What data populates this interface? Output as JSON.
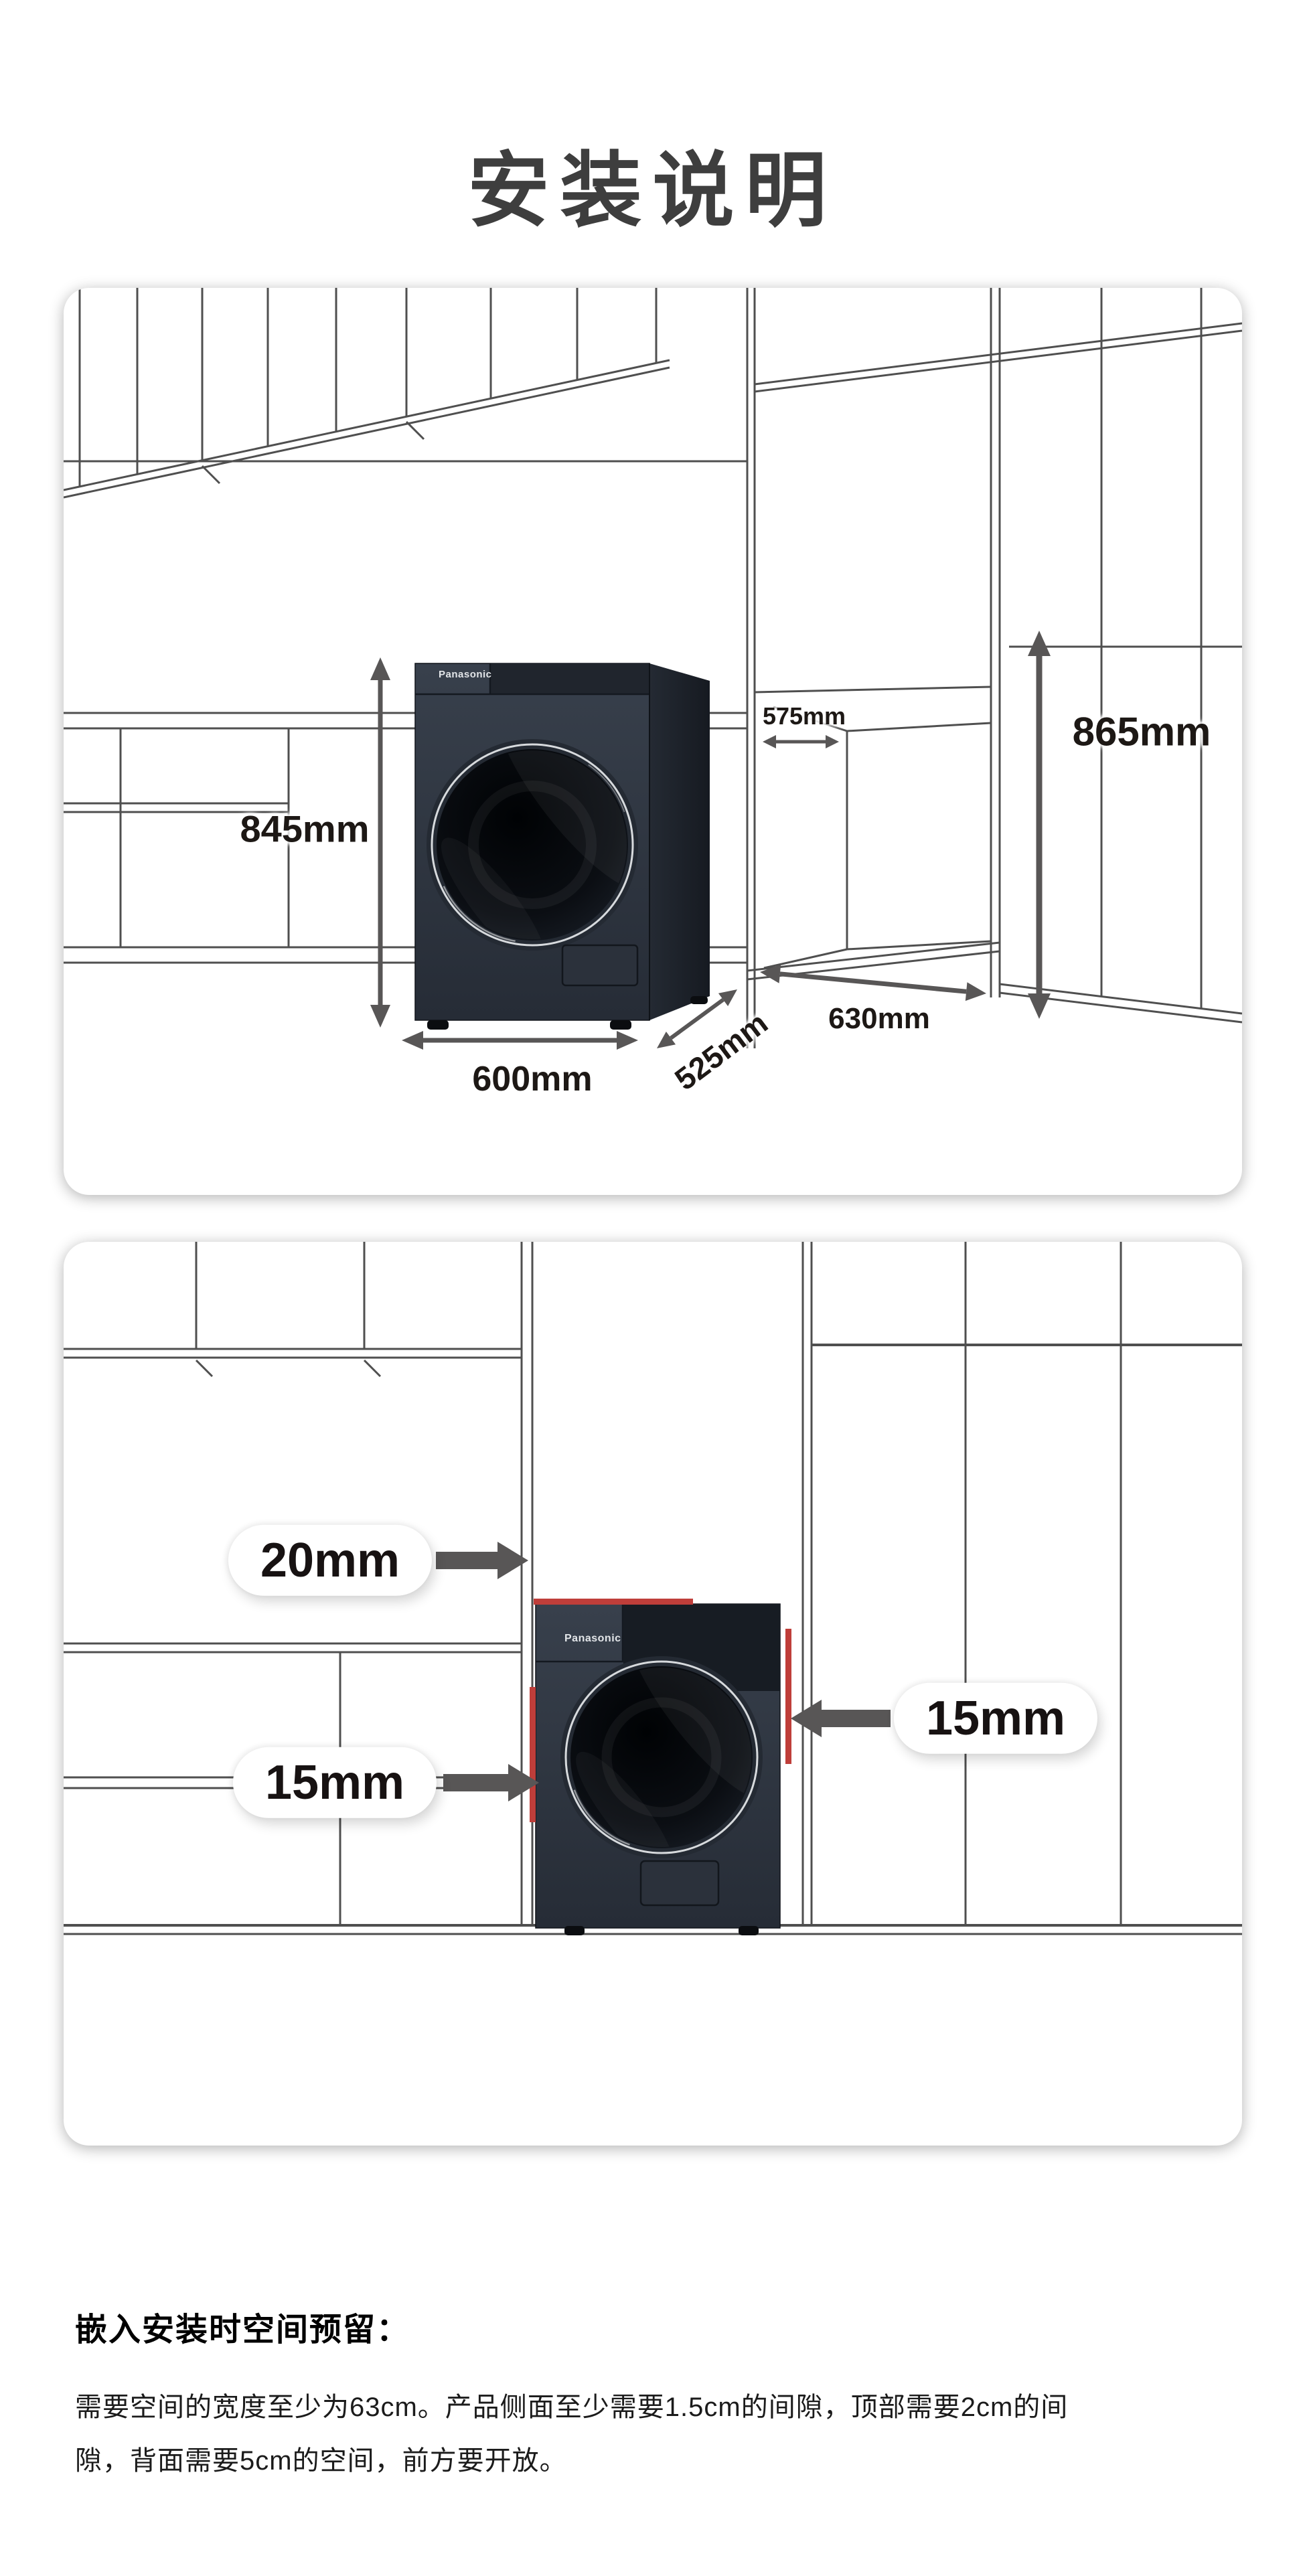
{
  "page": {
    "title": "安装说明"
  },
  "brand": "Panasonic",
  "overview_panel": {
    "machine_dimensions": {
      "height": "845mm",
      "width": "600mm",
      "depth": "525mm"
    },
    "niche_dimensions": {
      "opening_width": "575mm",
      "opening_height": "865mm",
      "opening_depth": "630mm"
    }
  },
  "embedded_panel": {
    "clearances": {
      "top": "20mm",
      "right_side": "15mm",
      "left_side": "15mm"
    }
  },
  "footer": {
    "heading": "嵌入安装时空间预留：",
    "body": "需要空间的宽度至少为63cm。产品侧面至少需要1.5cm的间隙，顶部需要2cm的间隙，背面需要5cm的空间，前方要开放。"
  },
  "colors": {
    "accent_red": "#bf3e3a",
    "cabinet_line": "#4f4f4f",
    "arrow_gray": "#585656",
    "machine_body": "#2e3540",
    "title_gray": "#3e3e3e"
  }
}
